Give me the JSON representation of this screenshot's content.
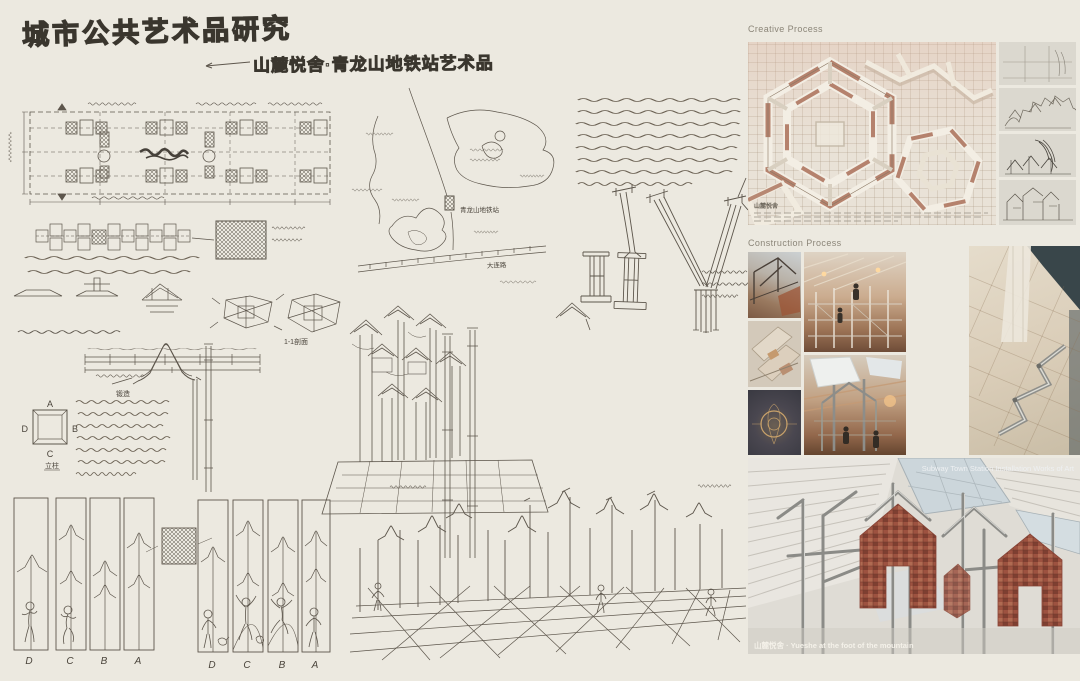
{
  "board": {
    "title": "城市公共艺术品研究",
    "subtitle": "山麓悦舍·青龙山地铁站艺术品"
  },
  "sketch": {
    "panel_letters": [
      "D",
      "C",
      "B",
      "A"
    ],
    "column_diagram": {
      "top": "A",
      "right": "B",
      "left": "D",
      "bottom": "C",
      "caption": "立柱"
    },
    "section_label": "1-1剖面",
    "forge_label": "锻造",
    "map": {
      "station": "青龙山地铁站",
      "road": "大连路"
    },
    "handwritten_notes": [
      "形式上以地铁站内出入口通行人流数，以减少“大兴土木”，进行成本造价的统筹把控布局（手写设计说明）",
      "主体公共艺术品以山地民居老房子为原型，以中国古典建筑美学为基底，以镂空铸造之意",
      "主体最高处的雏形记录",
      "柱梁以连锁不锈钢拉结有序固定，辅以传统符印穿插",
      "建筑轮廓下方以人的动态尺度为参考，再现地域生活气息",
      "保留用地砖面料",
      "不锈钢锻造"
    ]
  },
  "photos": {
    "creative": {
      "label": "Creative Process",
      "caption": "山麓悦舍"
    },
    "construction": {
      "label": "Construction Process"
    },
    "final": {
      "label": "Subway Town Station Installation Works of Art",
      "caption": "山麓悦舍 · Yueshe at the foot of the mountain"
    }
  },
  "colors": {
    "paper": "#ece9e0",
    "ink": "#5d564c",
    "brick": "#a96f58",
    "wood": "#b98f72",
    "steel": "#9a9a96"
  }
}
